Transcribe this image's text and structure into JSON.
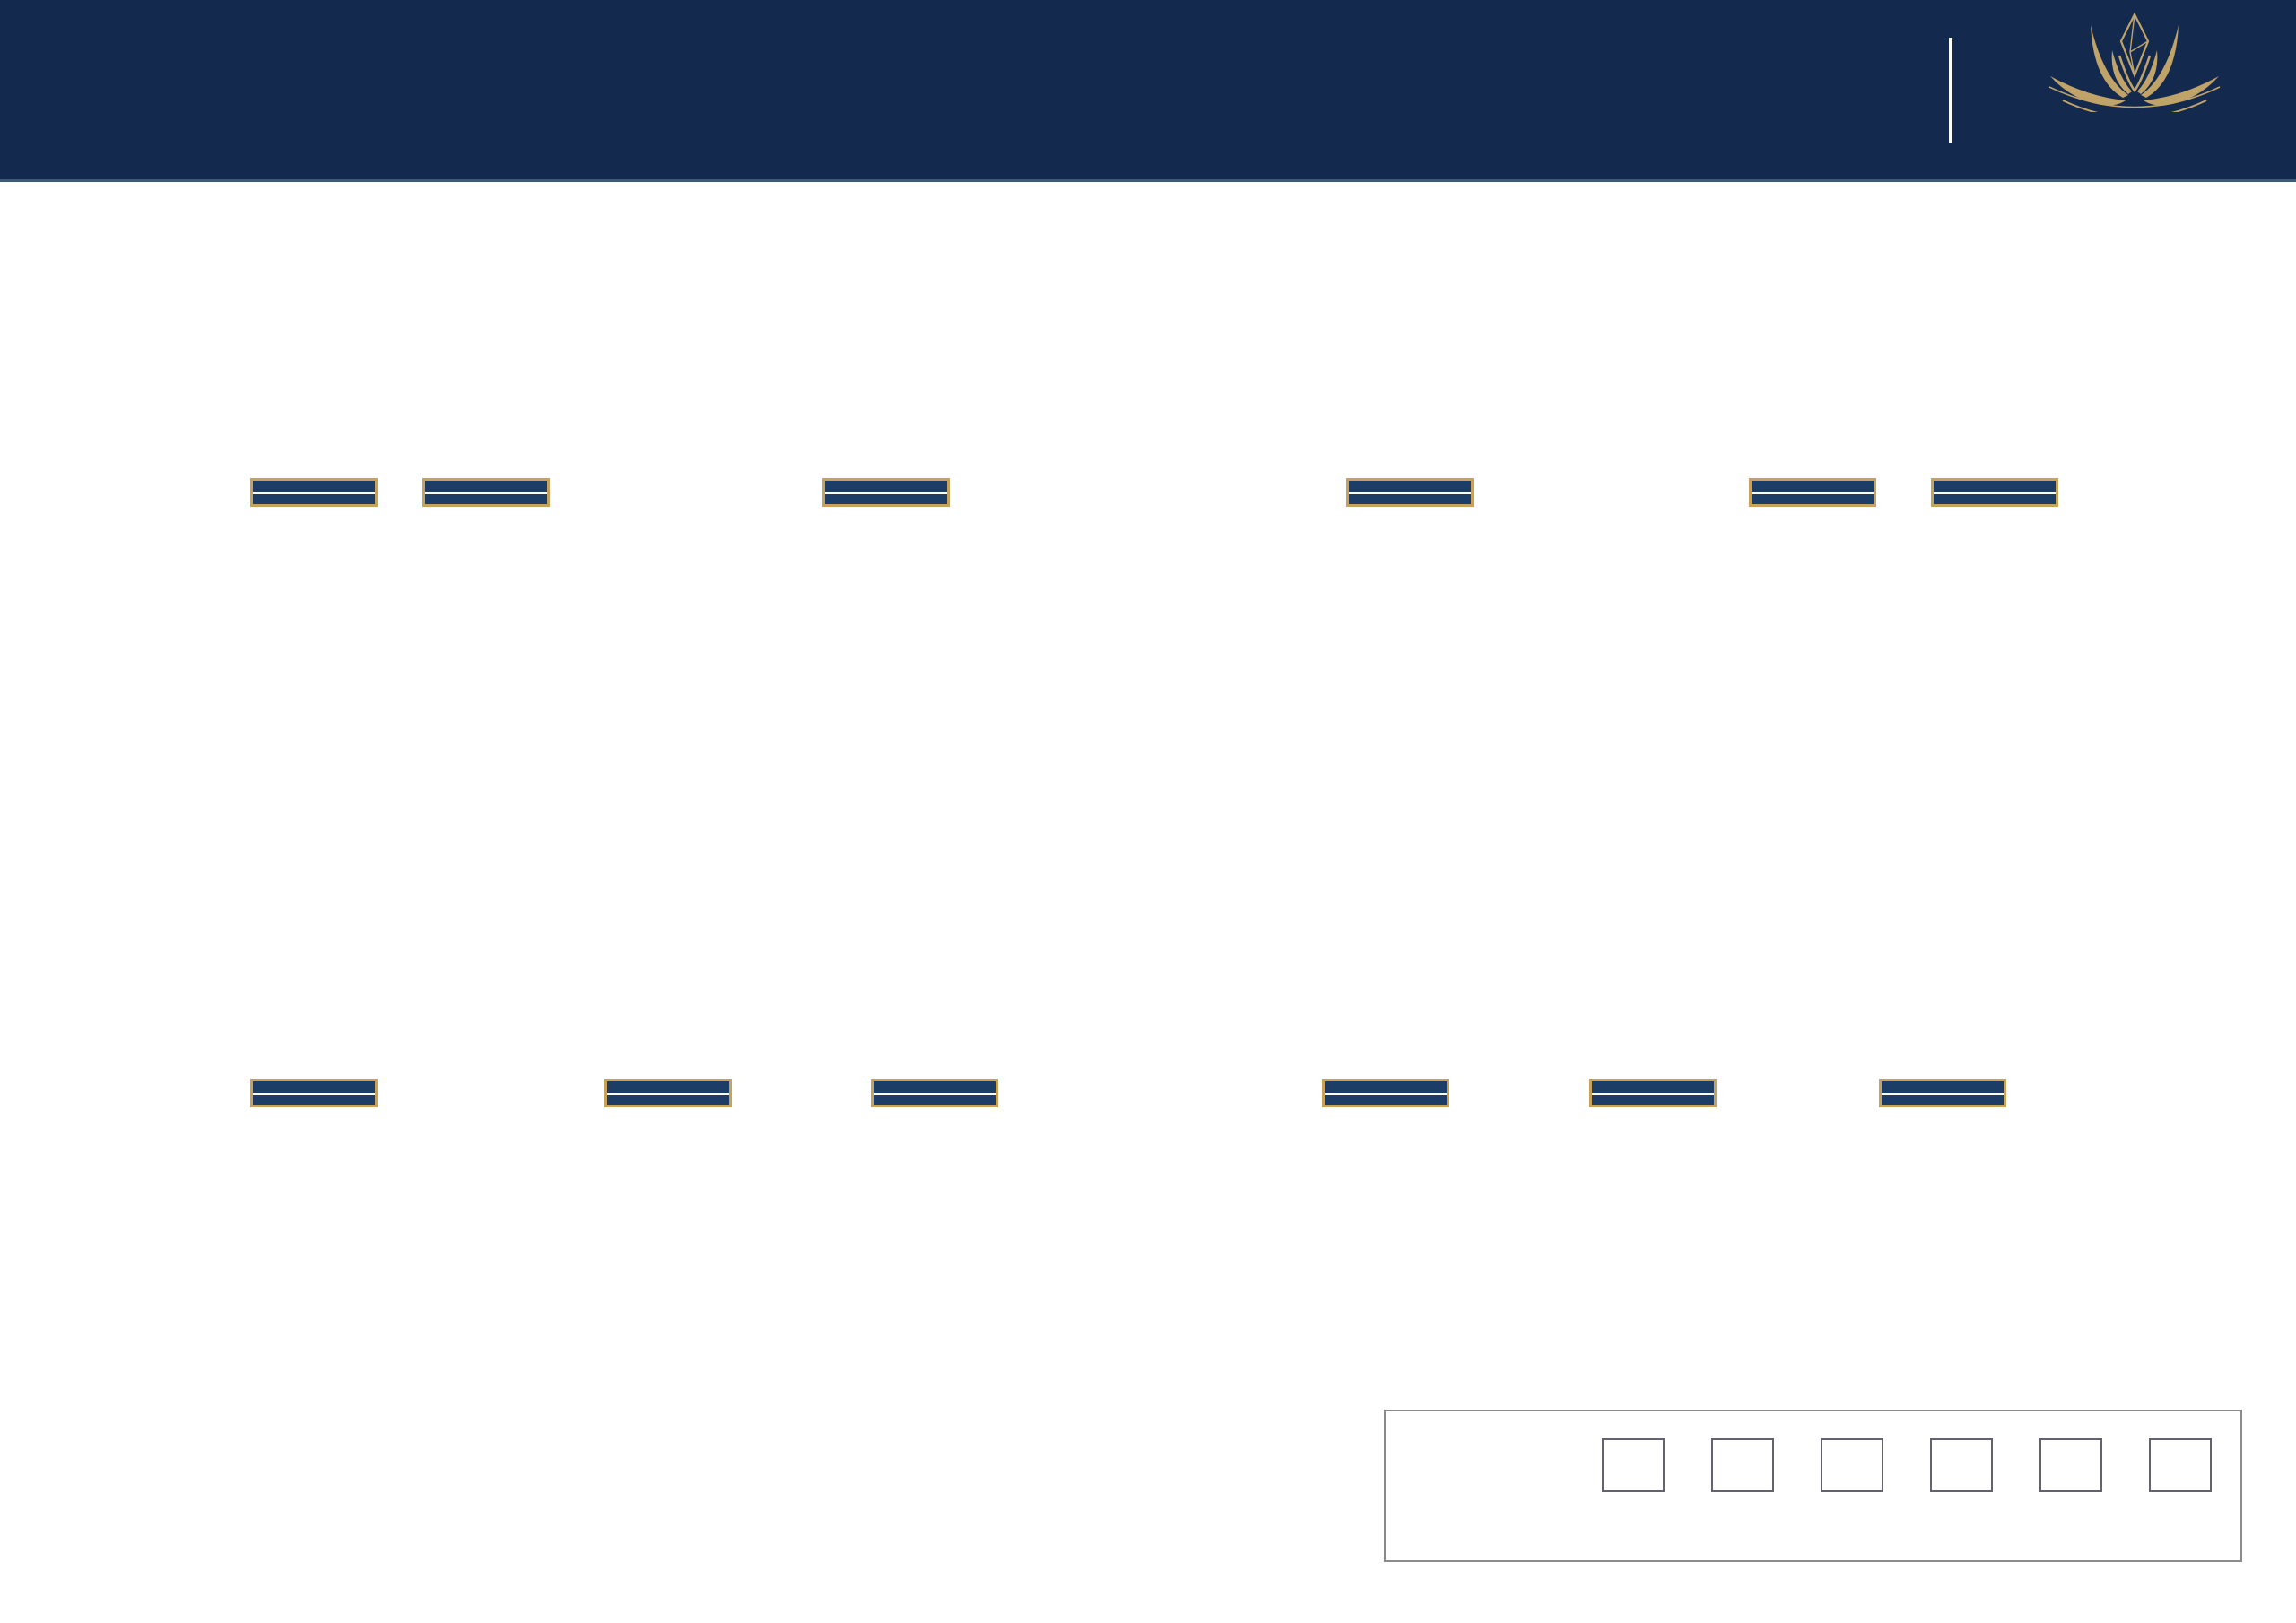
{
  "header": {
    "title": "MẶT BẰNG TẦNG 6.8.12.14.16 TL 1/200",
    "brand_name": "CELESTINE",
    "brand_sub": "WESTLAKE"
  },
  "compass": {
    "top": "T",
    "right": "B",
    "left": "N",
    "bottom": "Đ"
  },
  "plan": {
    "section_marker": "+A",
    "colors": {
      "ch01": "#eac6d3",
      "ch02": "#a4b5db",
      "ch03": "#f6dcae",
      "ch04": "#7ec4b8",
      "ch05": "#a6d8f0",
      "ch06": "#939fd6",
      "wall": "#161d36",
      "core_hatch": "#aab3dd",
      "gold": "#bfa369"
    }
  },
  "units": [
    {
      "code": "CH - 02A",
      "area": "84.6 M2",
      "color_key": "ch02"
    },
    {
      "code": "CH - 01A",
      "area": "55.8 M2",
      "color_key": "ch01"
    },
    {
      "code": "CH - 06A",
      "area": "118.2 M2",
      "color_key": "ch06"
    },
    {
      "code": "CH - 03A",
      "area": "138.3 M2",
      "color_key": "ch03"
    },
    {
      "code": "CH - 04A",
      "area": "125.0 M2",
      "color_key": "ch04"
    },
    {
      "code": "CH - 05A",
      "area": "110.6 M2",
      "color_key": "ch05"
    },
    {
      "code": "CH - 06B",
      "area": "118.2 M2",
      "color_key": "ch06"
    },
    {
      "code": "CH - 01B",
      "area": "55.8 M2",
      "color_key": "ch01"
    },
    {
      "code": "CH - 02B",
      "area": "84.6 M2",
      "color_key": "ch02"
    },
    {
      "code": "CH - 05B",
      "area": "110.6 M2",
      "color_key": "ch05"
    },
    {
      "code": "CH - 04B",
      "area": "125.0 M2",
      "color_key": "ch04"
    },
    {
      "code": "CH - 03B",
      "area": "138.3 M2",
      "color_key": "ch03"
    }
  ],
  "legend": {
    "heading": "CHÚ THÍCH:",
    "color_row_label": "Mã màu",
    "code_row_label": "Mã căn",
    "items": [
      {
        "code": "CH - 01",
        "color": "#e5c0ce"
      },
      {
        "code": "CH - 02",
        "color": "#a9c3e4"
      },
      {
        "code": "CH - 03",
        "color": "#8f97d0"
      },
      {
        "code": "CH - 04",
        "color": "#a8d9f3"
      },
      {
        "code": "CH - 05",
        "color": "#7fc3b7"
      },
      {
        "code": "CH - 06",
        "color": "#f7dcae"
      }
    ]
  }
}
